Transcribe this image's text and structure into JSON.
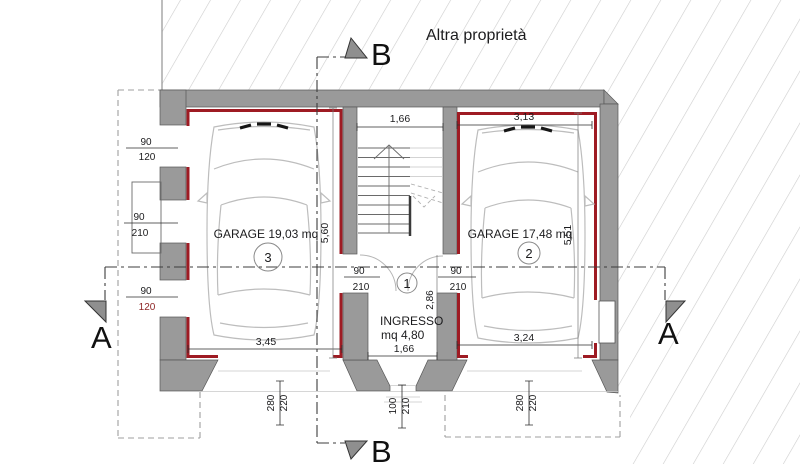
{
  "site": {
    "other_property_label": "Altra proprietà"
  },
  "section_markers": {
    "a": "A",
    "b": "B"
  },
  "rooms": {
    "garage_3": {
      "name_and_area": "GARAGE 19,03 mq",
      "number": "3",
      "width": "3,45",
      "depth": "5,60",
      "door": {
        "width": "280",
        "height": "220"
      }
    },
    "garage_2": {
      "name_and_area": "GARAGE 17,48 mq",
      "number": "2",
      "width": "3,24",
      "depth": "5,51",
      "door": {
        "width": "280",
        "height": "220"
      }
    },
    "ingresso": {
      "name": "INGRESSO",
      "area": "mq 4,80",
      "number": "1",
      "width": "1,66",
      "depth": "2,86",
      "door": {
        "width": "100",
        "height": "210"
      }
    }
  },
  "dimensions_top": {
    "stairwell_width": "1,66",
    "garage_2_width": "3,13"
  },
  "openings": {
    "left_wall_upper_window": {
      "width": "90",
      "height": "120"
    },
    "left_wall_door": {
      "width": "90",
      "height": "210"
    },
    "left_wall_lower_window": {
      "width": "90",
      "height": "120"
    },
    "landing_door_garage_3": {
      "width": "90",
      "height": "210"
    },
    "landing_door_garage_2": {
      "width": "90",
      "height": "210"
    }
  },
  "colors": {
    "wall": "#9a9a9a",
    "liner": "#9e1b23",
    "hatch": "#cdcdcd",
    "ink": "#1c1c1e",
    "dim_red": "#8f2727"
  }
}
